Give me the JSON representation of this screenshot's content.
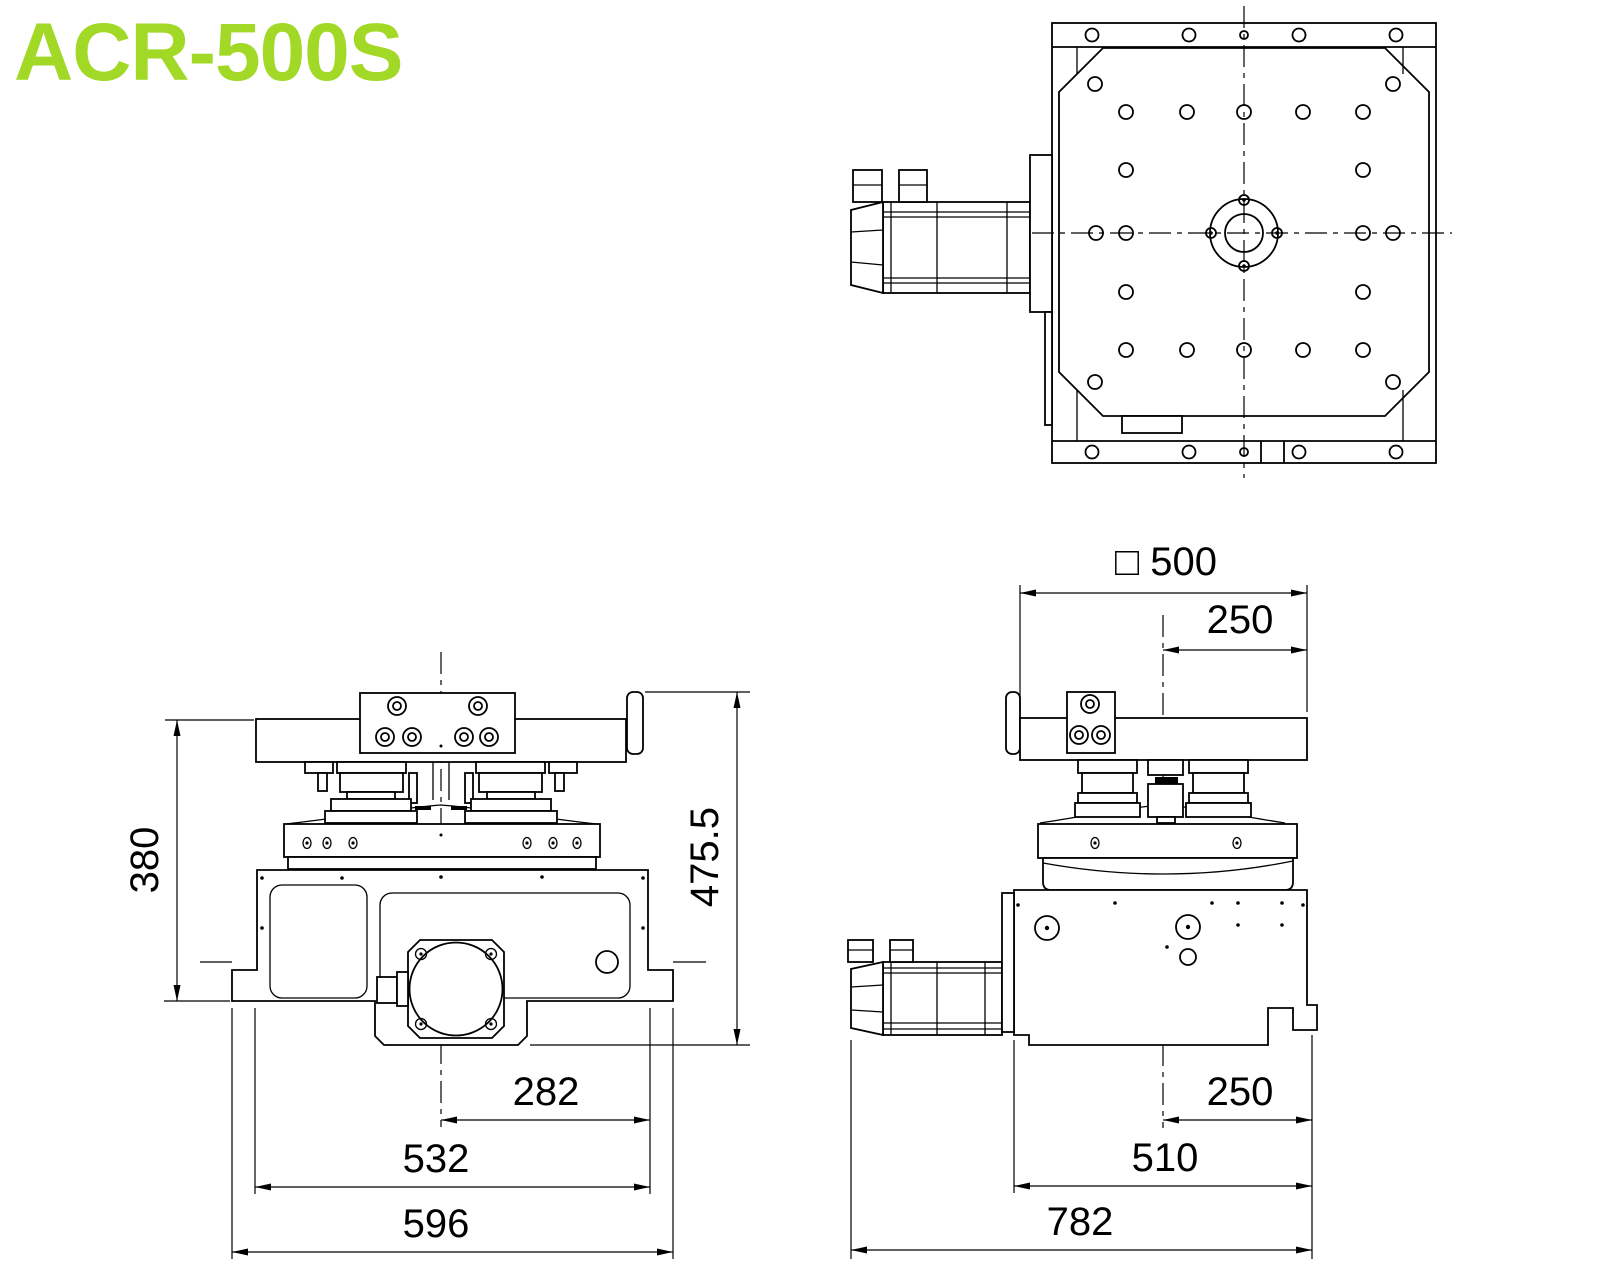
{
  "title": "ACR-500S",
  "accent_color": "#a2d826",
  "dimensions": {
    "front": {
      "table_height": "380",
      "overall_height": "475.5",
      "center_to_edge": "282",
      "body_width": "532",
      "base_width": "596"
    },
    "side": {
      "table_square": "□ 500",
      "center_top": "250",
      "center_bottom": "250",
      "base_length": "510",
      "overall_length": "782"
    }
  }
}
